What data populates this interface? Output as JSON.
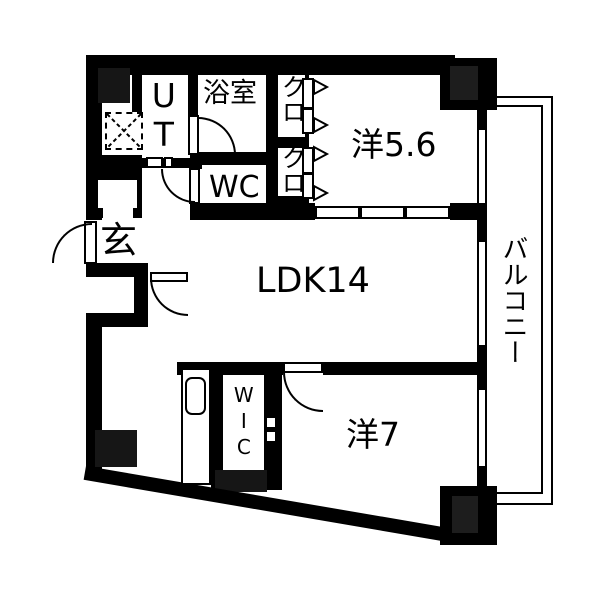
{
  "type": "apartment-floor-plan",
  "colors": {
    "wall": "#000000",
    "pillar": "#161616",
    "pillar_inner": "#1d1d1d",
    "background": "#ffffff"
  },
  "rooms": {
    "ldk": "LDK14",
    "bedroom_main": "洋5.6",
    "bedroom_second": "洋7",
    "balcony": "バルコニー",
    "bathroom": "浴室",
    "toilet": "WC",
    "utility": "UT",
    "entrance": "玄",
    "walk_in_closet": "WIC",
    "closet_upper": "クロ",
    "closet_lower": "クロ"
  }
}
